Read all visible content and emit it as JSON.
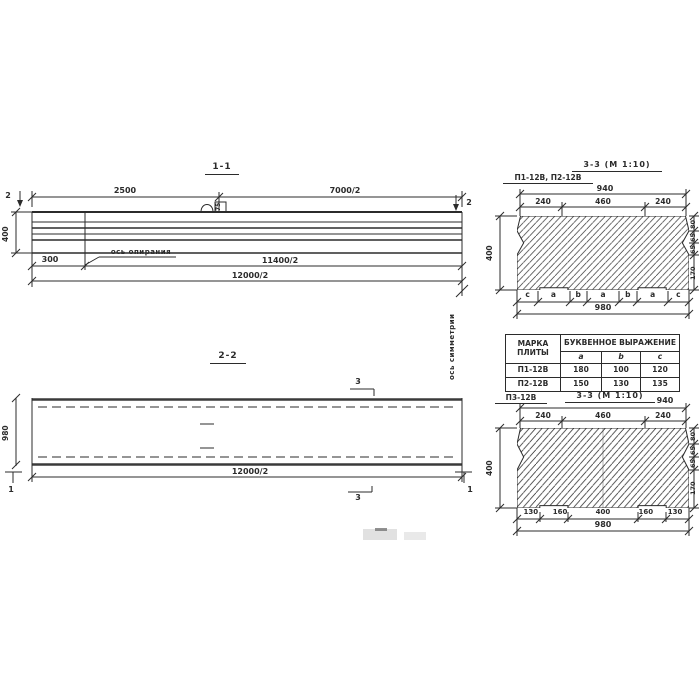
{
  "drawing": {
    "section_11": {
      "title": "1-1",
      "dim_2500": "2500",
      "dim_7000": "7000/2",
      "cut_mark_2": "2",
      "height_dim": "400",
      "loop_label": "75",
      "dim_300": "300",
      "support_axis_label": "ось опирания",
      "dim_11400": "11400/2",
      "dim_12000": "12000/2"
    },
    "section_22": {
      "title": "2-2",
      "cut_mark_3": "3",
      "cut_mark_1": "1",
      "height_dim": "980",
      "dim_12000": "12000/2"
    },
    "symmetry_axis_label": "ось симметрии",
    "section_33_top": {
      "title": "3-3 (М 1:10)",
      "marks_label": "П1-12В, П2-12В",
      "dim_940": "940",
      "top_dims": [
        "240",
        "460",
        "240"
      ],
      "height_dim": "400",
      "right_dims": [
        "80",
        "65",
        "65",
        "170"
      ],
      "letters": [
        "c",
        "a",
        "b",
        "a",
        "b",
        "a",
        "c"
      ],
      "dim_980": "980"
    },
    "table": {
      "col1_header": "МАРКА ПЛИТЫ",
      "group_header": "БУКВЕННОЕ ВЫРАЖЕНИЕ",
      "columns": [
        "a",
        "b",
        "c"
      ],
      "rows": [
        {
          "mark": "П1-12В",
          "a": "180",
          "b": "100",
          "c": "120"
        },
        {
          "mark": "П2-12В",
          "a": "150",
          "b": "130",
          "c": "135"
        }
      ]
    },
    "section_33_bottom": {
      "label": "П3-12В",
      "title": "3-3 (М 1:10)",
      "dim_940": "940",
      "top_dims": [
        "240",
        "460",
        "240"
      ],
      "height_dim": "400",
      "right_dims": [
        "80",
        "65",
        "65",
        "170"
      ],
      "bottom_dims": [
        "130",
        "160",
        "400",
        "160",
        "130"
      ],
      "dim_980": "980"
    },
    "ink_color": "#2b2b2b"
  }
}
